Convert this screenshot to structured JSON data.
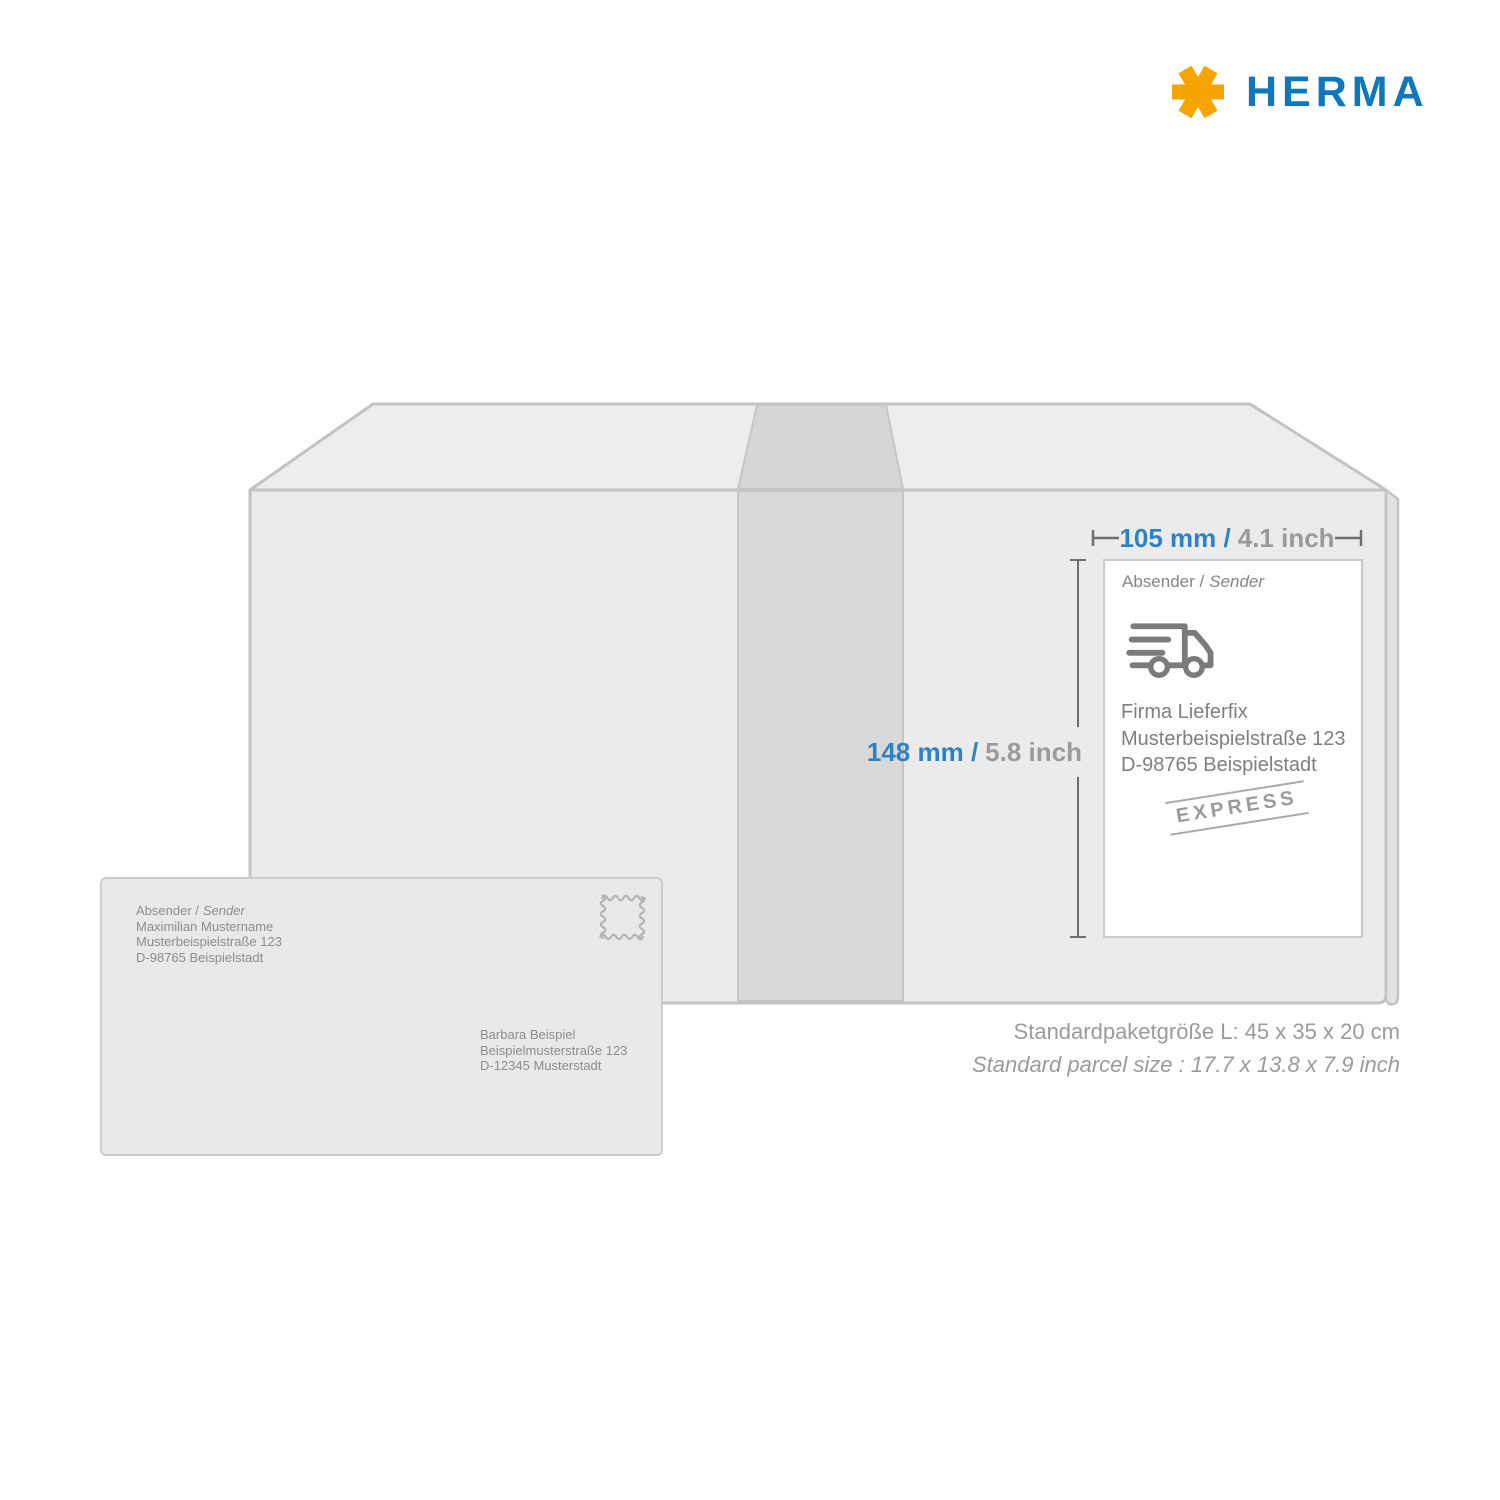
{
  "brand": {
    "name": "HERMA",
    "blue": "#0f78bd",
    "orange": "#f6a500"
  },
  "dimensions": {
    "width_value": "105 mm /",
    "width_alt": "4.1 inch",
    "height_value": "148 mm /",
    "height_alt": "5.8 inch",
    "accent_blue": "#2e82c4",
    "muted_gray": "#9a9a9a"
  },
  "shipping_label": {
    "sender_heading": "Absender /",
    "sender_heading_italic": "Sender",
    "address": [
      "Firma Lieferfix",
      "Musterbeispielstraße 123",
      "D-98765 Beispielstadt"
    ],
    "stamp": "EXPRESS",
    "truck_icon": "delivery-truck-icon"
  },
  "envelope": {
    "sender_heading": "Absender /",
    "sender_heading_italic": "Sender",
    "sender": [
      "Maximilian Mustername",
      "Musterbeispielstraße 123",
      "D-98765 Beispielstadt"
    ],
    "recipient": [
      "Barbara Beispiel",
      "Beispielmusterstraße 123",
      "D-12345 Musterstadt"
    ],
    "stamp_icon": "postage-stamp-outline-icon"
  },
  "parcel_info": {
    "line_metric": "Standardpaketgröße L: 45 x 35 x 20 cm",
    "line_imperial": "Standard parcel size : 17.7 x 13.8 x 7.9 inch"
  }
}
